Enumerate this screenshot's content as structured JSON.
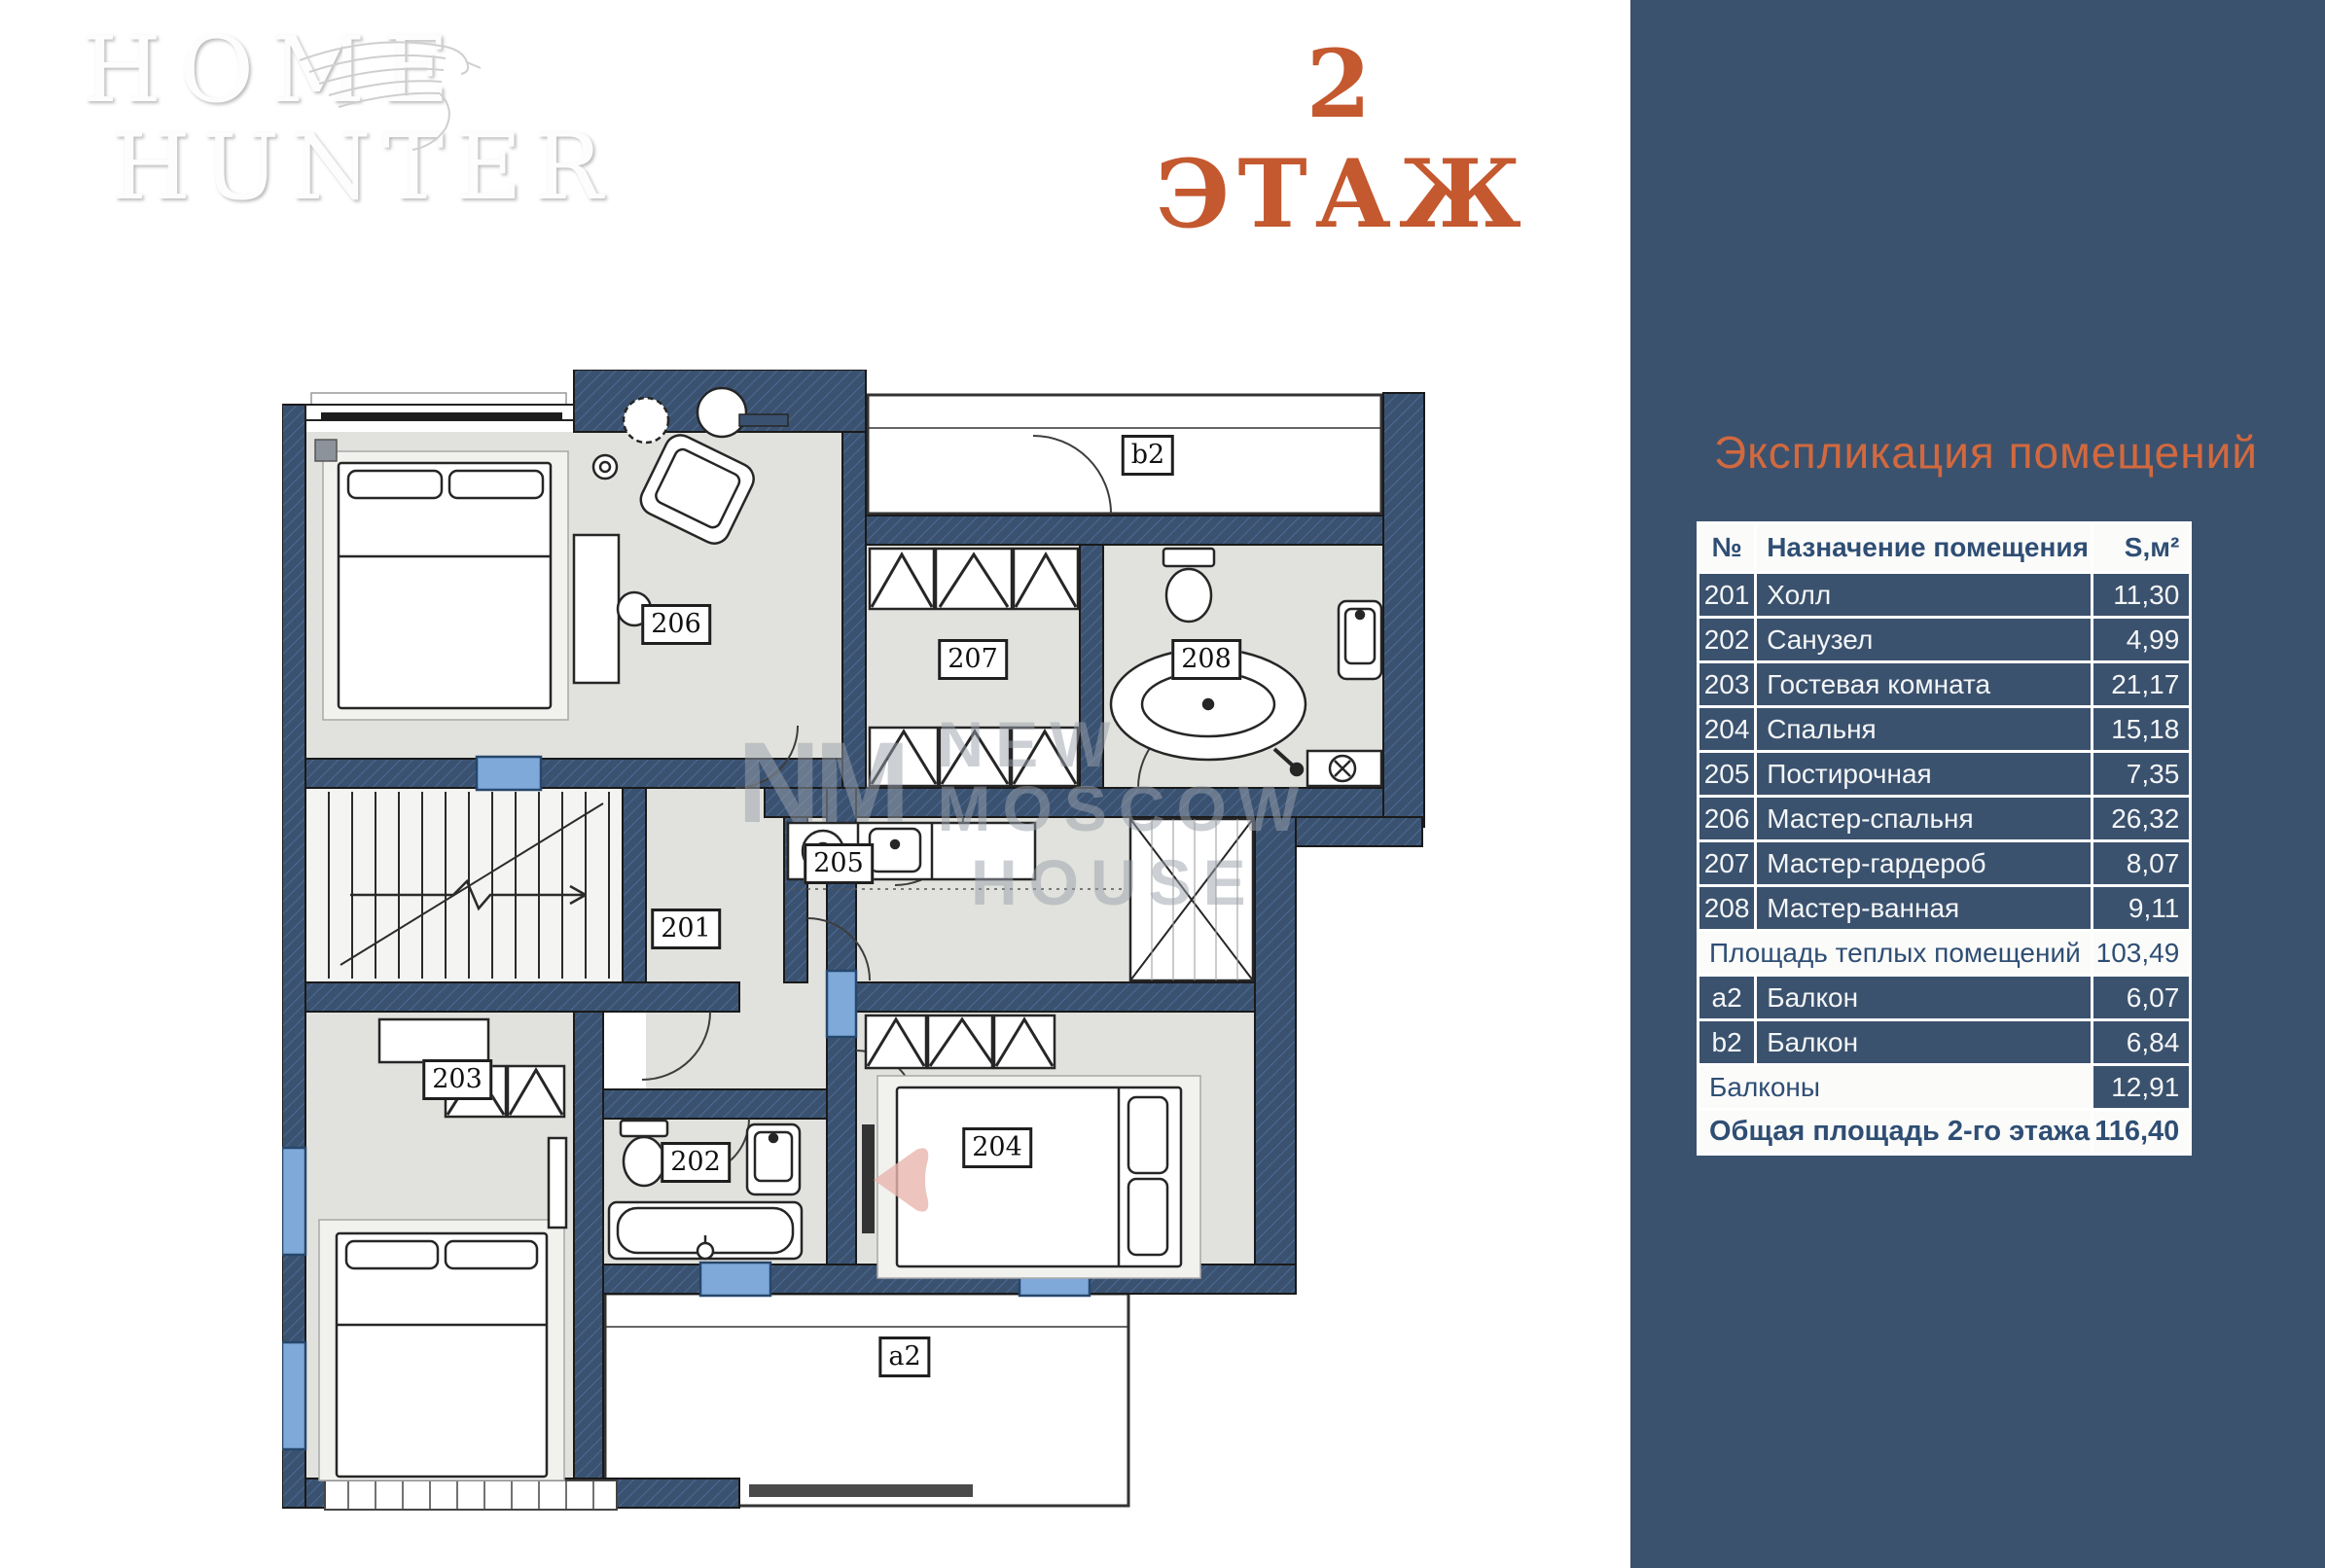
{
  "page": {
    "background": "#ffffff",
    "accent_orange": "#c4582e",
    "panel_navy": "#3b526e",
    "wall_navy": "#3a5270",
    "floor_gray": "#e1e2dd",
    "window_blue": "#7ea9d9"
  },
  "logo": {
    "line1": "HOME",
    "line2": "HUNTER"
  },
  "header": {
    "floor_title": "2 ЭТАЖ"
  },
  "watermark": {
    "monogram": "NM",
    "line1": "NEW MOSCOW",
    "line2": "HOUSE"
  },
  "plan": {
    "rooms": [
      {
        "id": "201",
        "label": "201"
      },
      {
        "id": "202",
        "label": "202"
      },
      {
        "id": "203",
        "label": "203"
      },
      {
        "id": "204",
        "label": "204"
      },
      {
        "id": "205",
        "label": "205"
      },
      {
        "id": "206",
        "label": "206"
      },
      {
        "id": "207",
        "label": "207"
      },
      {
        "id": "208",
        "label": "208"
      },
      {
        "id": "a2",
        "label": "a2"
      },
      {
        "id": "b2",
        "label": "b2"
      }
    ]
  },
  "sidebar": {
    "title": "Экспликация помещений",
    "table": {
      "columns": [
        "№",
        "Назначение помещения",
        "S,м²"
      ],
      "rows": [
        {
          "num": "201",
          "name": "Холл",
          "area": "11,30",
          "style": "data"
        },
        {
          "num": "202",
          "name": "Санузел",
          "area": "4,99",
          "style": "data"
        },
        {
          "num": "203",
          "name": "Гостевая комната",
          "area": "21,17",
          "style": "data"
        },
        {
          "num": "204",
          "name": "Спальня",
          "area": "15,18",
          "style": "data"
        },
        {
          "num": "205",
          "name": "Постирочная",
          "area": "7,35",
          "style": "data"
        },
        {
          "num": "206",
          "name": "Мастер-спальня",
          "area": "26,32",
          "style": "data"
        },
        {
          "num": "207",
          "name": "Мастер-гардероб",
          "area": "8,07",
          "style": "data"
        },
        {
          "num": "208",
          "name": "Мастер-ванная",
          "area": "9,11",
          "style": "data"
        },
        {
          "name": "Площадь теплых помещений",
          "area": "103,49",
          "style": "summary"
        },
        {
          "num": "a2",
          "name": "Балкон",
          "area": "6,07",
          "style": "data"
        },
        {
          "num": "b2",
          "name": "Балкон",
          "area": "6,84",
          "style": "data"
        },
        {
          "name": "Балконы",
          "area": "12,91",
          "style": "mixed"
        },
        {
          "name": "Общая площадь 2-го этажа",
          "area": "116,40",
          "style": "total"
        }
      ]
    }
  }
}
